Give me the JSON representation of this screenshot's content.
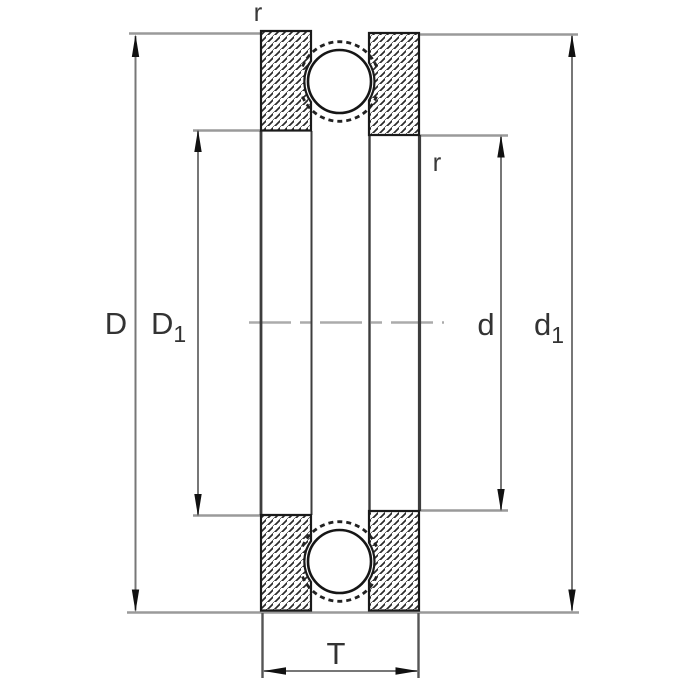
{
  "colors": {
    "background": "#ffffff",
    "outline": "#1a1a1a",
    "hatch": "#2a2a2a",
    "ball_fill": "#ffffff",
    "dimension_line": "#777777",
    "extension_line": "#9a9a9a",
    "center_line": "#ababab",
    "label_text": "#333333",
    "arrowhead": "#111111"
  },
  "dimensions": {
    "outer_diameter": {
      "base": "D",
      "sub": ""
    },
    "housing_washer_bore": {
      "base": "D",
      "sub": "1"
    },
    "bore": {
      "base": "d",
      "sub": ""
    },
    "shaft_washer_outside": {
      "base": "d",
      "sub": "1"
    },
    "height": {
      "base": "T",
      "sub": ""
    },
    "radius_top": {
      "base": "r",
      "sub": ""
    },
    "radius_inner": {
      "base": "r",
      "sub": ""
    }
  }
}
